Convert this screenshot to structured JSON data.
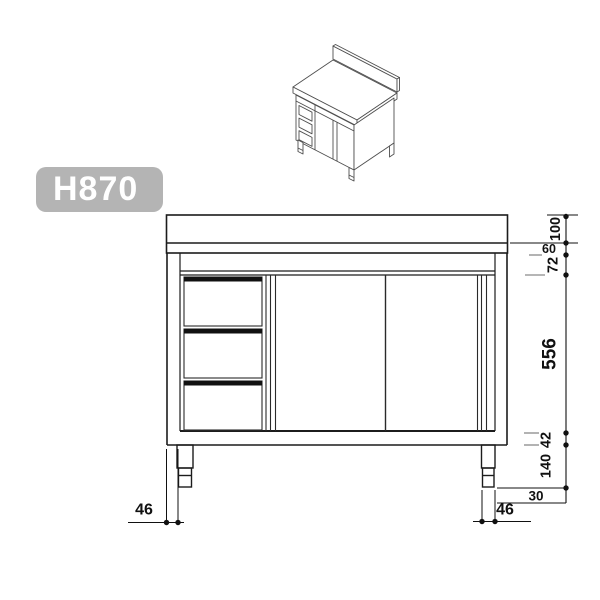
{
  "badge": {
    "label": "H870"
  },
  "thumbnail": {
    "name": "cabinet-isometric-view"
  },
  "dimensions": {
    "upstand_height": "100",
    "worktop_thickness": "60",
    "top_rail_height": "72",
    "door_opening_height": "556",
    "plinth_height": "42",
    "leg_height": "140",
    "foot_inset": "30",
    "leg_width_right": "46",
    "leg_width_left": "46"
  },
  "colors": {
    "badge_bg": "#b4b4b4",
    "badge_text": "#ffffff",
    "outline": "#1c1c1c",
    "dimension_line": "#111111",
    "extension_line": "#8a8a8a"
  }
}
